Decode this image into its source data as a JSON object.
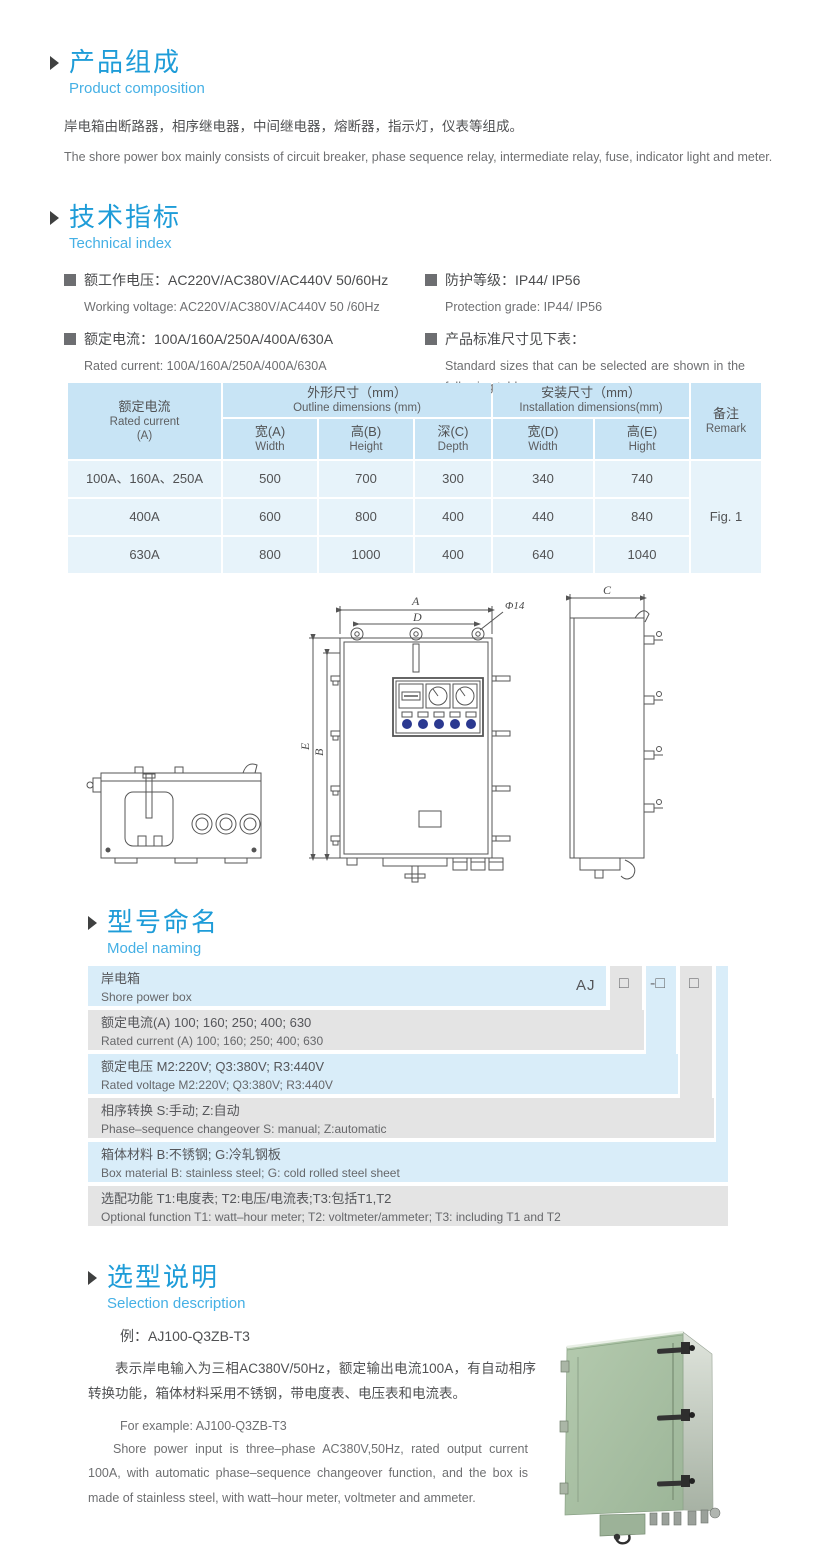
{
  "product_composition": {
    "title_zh": "产品组成",
    "title_en": "Product  composition",
    "body_zh": "岸电箱由断路器，相序继电器，中间继电器，熔断器，指示灯，仪表等组成。",
    "body_en": "The shore power box mainly consists of circuit breaker, phase sequence relay, intermediate relay, fuse, indicator light and meter."
  },
  "technical_index": {
    "title_zh": "技术指标",
    "title_en": "Technical index",
    "specs": [
      {
        "zh": "额工作电压：AC220V/AC380V/AC440V  50/60Hz",
        "en": "Working voltage: AC220V/AC380V/AC440V 50 /60Hz"
      },
      {
        "zh": "额定电流：100A/160A/250A/400A/630A",
        "en": "Rated current: 100A/160A/250A/400A/630A"
      },
      {
        "zh": "防护等级：IP44/ IP56",
        "en": "Protection grade: IP44/ IP56"
      },
      {
        "zh": "产品标准尺寸见下表：",
        "en": "Standard sizes that can be selected are shown in the following table"
      }
    ]
  },
  "dim_table": {
    "c1_zh": "额定电流",
    "c1_en": "Rated current",
    "c1_unit": "(A)",
    "g1_zh": "外形尺寸（mm）",
    "g1_en": "Outline dimensions (mm)",
    "g2_zh": "安装尺寸（mm）",
    "g2_en": "Installation dimensions(mm)",
    "remark_zh": "备注",
    "remark_en": "Remark",
    "sub": [
      {
        "zh": "宽(A)",
        "en": "Width"
      },
      {
        "zh": "高(B)",
        "en": "Height"
      },
      {
        "zh": "深(C)",
        "en": "Depth"
      },
      {
        "zh": "宽(D)",
        "en": "Width"
      },
      {
        "zh": "高(E)",
        "en": "Hight"
      }
    ],
    "rows": [
      {
        "current": "100A、160A、250A",
        "values": [
          "500",
          "700",
          "300",
          "340",
          "740"
        ]
      },
      {
        "current": "400A",
        "values": [
          "600",
          "800",
          "400",
          "440",
          "840"
        ]
      },
      {
        "current": "630A",
        "values": [
          "800",
          "1000",
          "400",
          "640",
          "1040"
        ]
      }
    ],
    "remark_value": "Fig. 1"
  },
  "drawings": {
    "labels": {
      "a": "A",
      "d": "D",
      "hole": "Φ14",
      "e": "E",
      "b": "B",
      "c": "C"
    }
  },
  "model_naming": {
    "title_zh": "型号命名",
    "title_en": "Model naming",
    "prefix": "AJ",
    "ph1": "□",
    "ph2": "-□",
    "ph3": "□",
    "rows": [
      {
        "zh": "岸电箱",
        "en": "Shore power box"
      },
      {
        "zh": "额定电流(A)  100; 160; 250; 400; 630",
        "en": "Rated current (A) 100; 160; 250; 400; 630"
      },
      {
        "zh": "额定电压   M2:220V;  Q3:380V;  R3:440V",
        "en": "Rated voltage  M2:220V;  Q3:380V;  R3:440V"
      },
      {
        "zh": "相序转换  S:手动; Z:自动",
        "en": "Phase–sequence changeover  S: manual;  Z:automatic"
      },
      {
        "zh": "箱体材料    B:不锈钢;  G:冷轧钢板",
        "en": "Box material   B: stainless steel; G: cold rolled steel sheet"
      },
      {
        "zh": "选配功能      T1:电度表;  T2:电压/电流表;T3:包括T1,T2",
        "en": "Optional function  T1: watt–hour meter; T2: voltmeter/ammeter; T3: including T1 and T2"
      }
    ]
  },
  "selection": {
    "title_zh": "选型说明",
    "title_en": "Selection description",
    "example_zh": "例：AJ100-Q3ZB-T3",
    "desc_zh": "表示岸电输入为三相AC380V/50Hz，额定输出电流100A，有自动相序转换功能，箱体材料采用不锈钢，带电度表、电压表和电流表。",
    "example_en": "For example: AJ100-Q3ZB-T3",
    "desc_en": "Shore power input is three–phase AC380V,50Hz, rated output current 100A, with automatic phase–sequence changeover function, and the box is made of stainless steel, with watt–hour meter, voltmeter and ammeter."
  },
  "colors": {
    "accent": "#1e9cd8",
    "accent_light": "#45b0e5",
    "table_header": "#c8e4f5",
    "table_row": "#e7f3fa",
    "band_blue": "#d9edf9",
    "band_gray": "#e4e4e4",
    "box_green": "#a9c2a4"
  }
}
